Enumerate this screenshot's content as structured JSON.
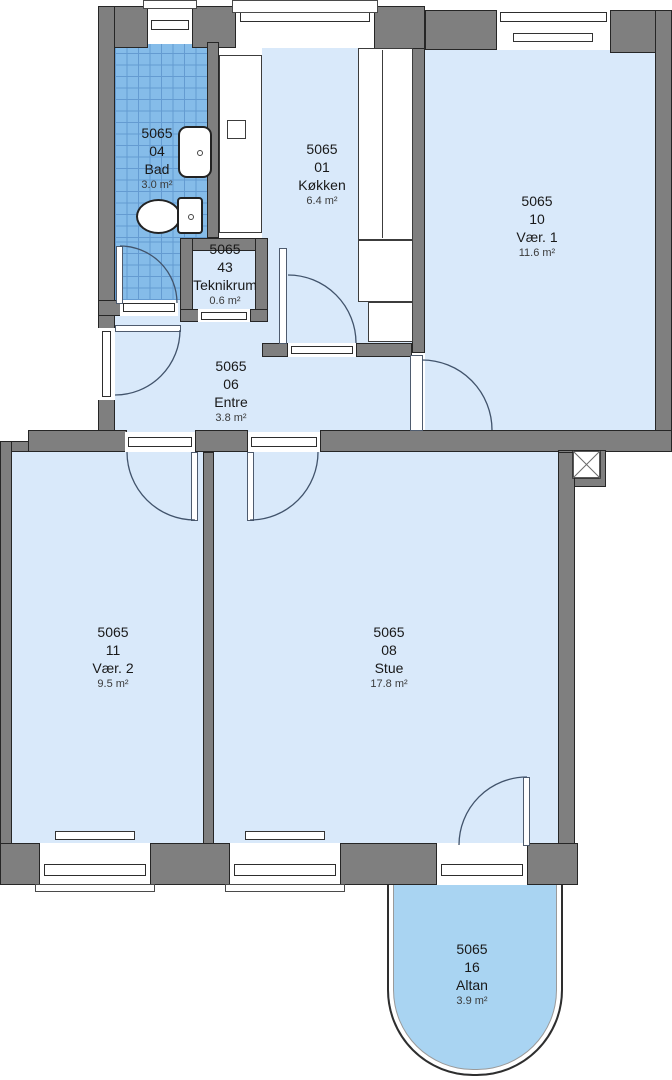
{
  "plan": {
    "building_no": "5065",
    "rooms": [
      {
        "no": "04",
        "name": "Bad",
        "area": "3.0 m²"
      },
      {
        "no": "01",
        "name": "Køkken",
        "area": "6.4 m²"
      },
      {
        "no": "10",
        "name": "Vær. 1",
        "area": "11.6 m²"
      },
      {
        "no": "43",
        "name": "Teknikrum",
        "area": "0.6 m²"
      },
      {
        "no": "06",
        "name": "Entre",
        "area": "3.8 m²"
      },
      {
        "no": "11",
        "name": "Vær. 2",
        "area": "9.5 m²"
      },
      {
        "no": "08",
        "name": "Stue",
        "area": "17.8 m²"
      },
      {
        "no": "16",
        "name": "Altan",
        "area": "3.9 m²"
      }
    ],
    "fixtures": [
      "toilet",
      "sink",
      "kitchen-counter",
      "radiator",
      "shaft",
      "window",
      "door"
    ],
    "colors": {
      "wall": "#7f7f7f",
      "room_fill": "#d9e9fa",
      "bath_tile": "#85bce9",
      "balcony_fill": "#a9d4f2",
      "door_arc": "#41536b"
    }
  }
}
